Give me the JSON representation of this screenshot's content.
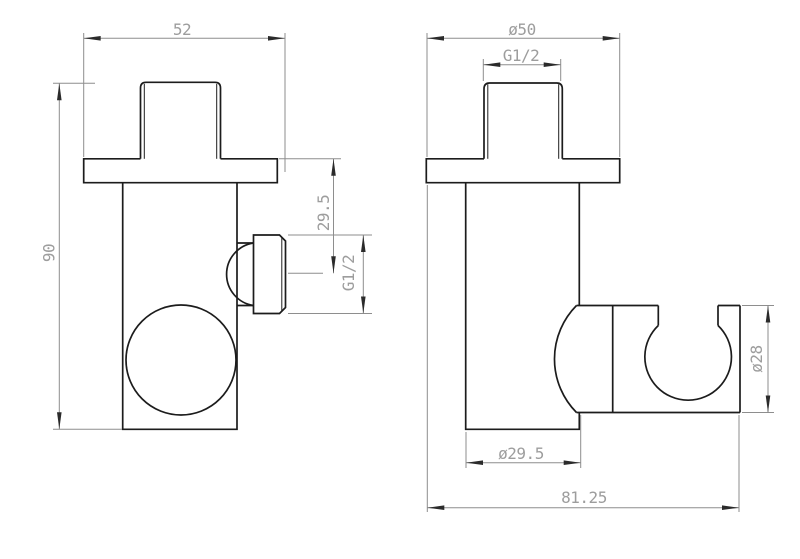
{
  "drawing": {
    "front_view": {
      "dim_flange_width": "52",
      "dim_overall_height": "90",
      "dim_port_center_offset": "29.5",
      "dim_port_thread": "G1/2"
    },
    "side_view": {
      "dim_flange_diameter": "ø50",
      "dim_inlet_thread": "G1/2",
      "dim_body_diameter": "ø29.5",
      "dim_overall_depth": "81.25",
      "dim_holder_diameter": "ø28"
    },
    "colors": {
      "object_line": "#1c1c1c",
      "dimension_line": "#8e8e8e",
      "dimension_text": "#9d9d9d",
      "arrow_fill": "#2b2b2b",
      "background": "#ffffff"
    }
  }
}
